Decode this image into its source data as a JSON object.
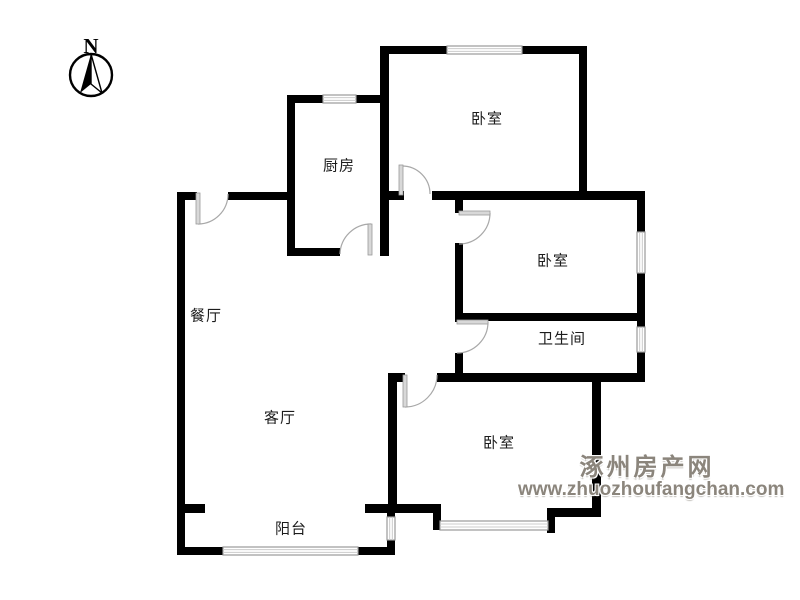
{
  "page": {
    "background": "#ffffff"
  },
  "compass": {
    "label": "N"
  },
  "watermark": {
    "line1": "涿州房产网",
    "line2": "www.zhuozhoufangchan.com"
  },
  "colors": {
    "wall": "#000000",
    "door_leaf": "#d8d8d8",
    "door_leaf_edge": "#9a9a9a",
    "door_arc": "#a8a8a8",
    "window_frame": "#9a9a9a",
    "window_pane": "#cccccc",
    "label_text": "#1c1c1c",
    "watermark_text": "#8b857c"
  },
  "rooms": [
    {
      "id": "kitchen",
      "label": "厨房",
      "x": 339,
      "y": 165
    },
    {
      "id": "bedroom-top",
      "label": "卧室",
      "x": 487,
      "y": 118
    },
    {
      "id": "bedroom-middle",
      "label": "卧室",
      "x": 553,
      "y": 260
    },
    {
      "id": "bathroom",
      "label": "卫生间",
      "x": 562,
      "y": 338
    },
    {
      "id": "dining-room",
      "label": "餐厅",
      "x": 206,
      "y": 315
    },
    {
      "id": "living-room",
      "label": "客厅",
      "x": 280,
      "y": 417
    },
    {
      "id": "bedroom-bottom",
      "label": "卧室",
      "x": 499,
      "y": 442
    },
    {
      "id": "balcony",
      "label": "阳台",
      "x": 291,
      "y": 528
    }
  ],
  "plan": {
    "walls": [
      [
        177,
        192,
        20,
        8
      ],
      [
        228,
        192,
        62,
        8
      ],
      [
        177,
        192,
        8,
        363
      ],
      [
        287,
        95,
        8,
        161
      ],
      [
        287,
        95,
        98,
        8
      ],
      [
        287,
        248,
        53,
        8
      ],
      [
        380,
        46,
        9,
        210
      ],
      [
        380,
        46,
        207,
        8
      ],
      [
        579,
        46,
        8,
        153
      ],
      [
        388,
        191,
        16,
        9
      ],
      [
        432,
        191,
        213,
        9
      ],
      [
        637,
        195,
        8,
        183
      ],
      [
        455,
        195,
        8,
        18
      ],
      [
        455,
        243,
        8,
        79
      ],
      [
        455,
        353,
        8,
        22
      ],
      [
        463,
        313,
        182,
        8
      ],
      [
        388,
        373,
        17,
        9
      ],
      [
        437,
        373,
        208,
        9
      ],
      [
        388,
        373,
        9,
        140
      ],
      [
        592,
        373,
        9,
        144
      ],
      [
        547,
        508,
        54,
        9
      ],
      [
        547,
        508,
        8,
        25
      ],
      [
        433,
        504,
        8,
        26
      ],
      [
        393,
        504,
        48,
        9
      ],
      [
        177,
        504,
        28,
        9
      ],
      [
        365,
        504,
        30,
        9
      ],
      [
        387,
        505,
        8,
        13
      ],
      [
        387,
        539,
        8,
        16
      ],
      [
        177,
        547,
        46,
        8
      ],
      [
        357,
        547,
        38,
        8
      ]
    ],
    "windows": [
      [
        323,
        95,
        33,
        8,
        "h"
      ],
      [
        447,
        46,
        75,
        8,
        "h"
      ],
      [
        637,
        232,
        8,
        41,
        "v"
      ],
      [
        637,
        327,
        8,
        25,
        "v"
      ],
      [
        440,
        521,
        108,
        9,
        "h"
      ],
      [
        223,
        547,
        135,
        8,
        "h"
      ],
      [
        387,
        517,
        8,
        23,
        "v"
      ]
    ],
    "door_leaves": [
      [
        196,
        193,
        4,
        31
      ],
      [
        368,
        224,
        4,
        31
      ],
      [
        399,
        165,
        4,
        30
      ],
      [
        459,
        211,
        31,
        4
      ],
      [
        457,
        320,
        31,
        4
      ],
      [
        403,
        375,
        4,
        32
      ]
    ],
    "door_arcs": [
      "M 198 224 A 30 30 0 0 0 228 194",
      "M 340 254 A 31 31 0 0 1 371 224",
      "M 430 194 A 28 28 0 0 0 402 166",
      "M 490 213 A 31 31 0 0 1 459 244",
      "M 488 322 A 31 31 0 0 1 457 353",
      "M 405 407 A 32 32 0 0 0 437 375"
    ]
  }
}
